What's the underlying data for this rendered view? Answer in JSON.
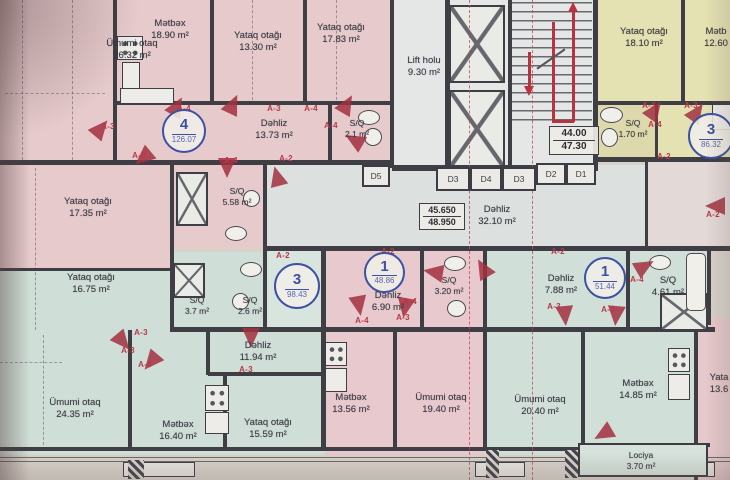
{
  "meta": {
    "type": "architectural floor plan (scanned)",
    "language": "Azerbaijani"
  },
  "colors": {
    "pink_apartment": "#e6cacc",
    "green_apartment": "#cfded6",
    "yellow_apartment": "#e4e1b2",
    "corridor_gray": "#dce1e0",
    "wall": "#3f3e44",
    "axis_red": "#b8394a",
    "unit_circle_blue": "#3d51a3",
    "paper": "#d8d2cb"
  },
  "rooms": [
    {
      "name": "Ümumi otaq",
      "area": "26.32 m²"
    },
    {
      "name": "Mətbəx",
      "area": "18.90 m²"
    },
    {
      "name": "Yataq otağı",
      "area": "13.30 m²"
    },
    {
      "name": "Yataq otağı",
      "area": "17.83 m²"
    },
    {
      "name": "Dəhliz",
      "area": "13.73 m²"
    },
    {
      "name": "S/Q",
      "area": "2.1 m²"
    },
    {
      "name": "S/Q",
      "area": "5.58 m²"
    },
    {
      "name": "Yataq otağı",
      "area": "17.35 m²"
    },
    {
      "name": "Lift holu",
      "area": "9.30 m²"
    },
    {
      "name": "Dəhliz",
      "area": "32.10 m²"
    },
    {
      "name": "Yataq otağı",
      "area": "18.10 m²"
    },
    {
      "name": "Mətb",
      "area": "12.60"
    },
    {
      "name": "S/Q",
      "area": "1.70 m²"
    },
    {
      "name": "Yataq otağı",
      "area": "16.75 m²"
    },
    {
      "name": "S/Q",
      "area": "3.7 m²"
    },
    {
      "name": "S/Q",
      "area": "2.6 m²"
    },
    {
      "name": "Dəhliz",
      "area": "11.94 m²"
    },
    {
      "name": "Yataq otağı",
      "area": "15.59 m²"
    },
    {
      "name": "Mətbəx",
      "area": "16.40 m²"
    },
    {
      "name": "Ümumi otaq",
      "area": "24.35 m²"
    },
    {
      "name": "Dəhliz",
      "area": "6.90 m²"
    },
    {
      "name": "S/Q",
      "area": "3.20 m²"
    },
    {
      "name": "Mətbəx",
      "area": "13.56 m²"
    },
    {
      "name": "Ümumi otaq",
      "area": "19.40 m²"
    },
    {
      "name": "Dəhliz",
      "area": "7.88 m²"
    },
    {
      "name": "S/Q",
      "area": "4.61 m²"
    },
    {
      "name": "Ümumi otaq",
      "area": "20.40 m²"
    },
    {
      "name": "Mətbəx",
      "area": "14.85 m²"
    },
    {
      "name": "Lociya",
      "area": "3.70 m²"
    },
    {
      "name": "Yata",
      "area": "13.6"
    }
  ],
  "unit_circles": [
    {
      "unit": "4",
      "area": "126.07"
    },
    {
      "unit": "3",
      "area": "86.32"
    },
    {
      "unit": "3",
      "area": "98.43"
    },
    {
      "unit": "1",
      "area": "48.86"
    },
    {
      "unit": "1",
      "area": "51.44"
    }
  ],
  "levels": {
    "corridor": {
      "top": "45.650",
      "bottom": "48.950"
    },
    "stairs": {
      "top": "44.00",
      "bottom": "47.30"
    }
  },
  "doors": [
    "D5",
    "D3",
    "D4",
    "D3",
    "D2",
    "D1"
  ],
  "axis_labels": [
    {
      "t": "A-3"
    },
    {
      "t": "A-4"
    },
    {
      "t": "A-3"
    },
    {
      "t": "A-3"
    },
    {
      "t": "A-4"
    },
    {
      "t": "A-4"
    },
    {
      "t": "A-2"
    },
    {
      "t": "A-4"
    },
    {
      "t": "A-3"
    },
    {
      "t": "A-3"
    },
    {
      "t": "A-2"
    },
    {
      "t": "A-2"
    },
    {
      "t": "A-2"
    },
    {
      "t": "A-2"
    },
    {
      "t": "A-4"
    },
    {
      "t": "A-4"
    },
    {
      "t": "A-3"
    },
    {
      "t": "A-2"
    },
    {
      "t": "A-4"
    },
    {
      "t": "A-3"
    },
    {
      "t": "A-3"
    },
    {
      "t": "A-3"
    },
    {
      "t": "A-4"
    },
    {
      "t": "A-3"
    },
    {
      "t": "A-3"
    },
    {
      "t": "A-4"
    }
  ]
}
